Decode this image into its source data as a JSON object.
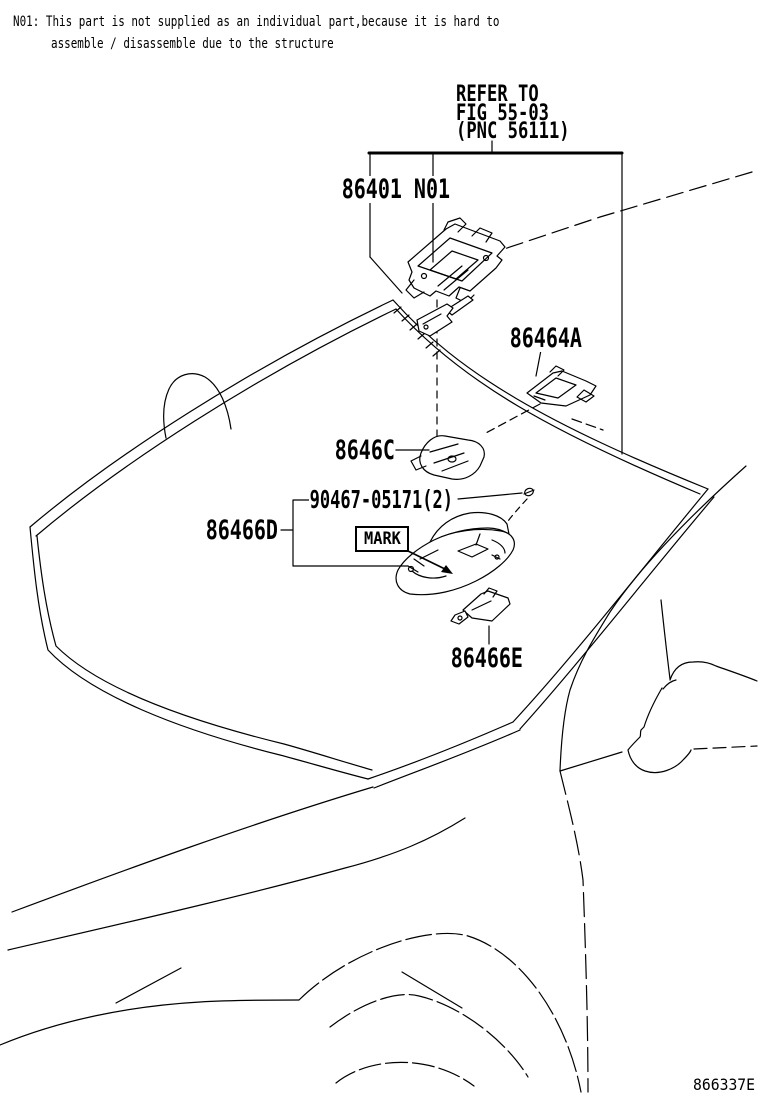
{
  "note": {
    "line1": "N01: This part is not supplied as an individual part,because it is hard to",
    "line2": "assemble / disassemble due to the structure"
  },
  "refer_to": {
    "line1": "REFER TO",
    "line2": "FIG 55-03",
    "line3": "(PNC 56111)"
  },
  "part_labels": {
    "camera_assembly": "86401 N01",
    "bracket_86464a": "86464A",
    "sensor_8646c": "8646C",
    "screw_90467": "90467-05171(2)",
    "cover_86466d": "86466D",
    "mark_tag": "MARK",
    "bracket_86466e": "86466E"
  },
  "figure_code": "866337E",
  "colors": {
    "line": "#000000",
    "background": "#ffffff"
  }
}
